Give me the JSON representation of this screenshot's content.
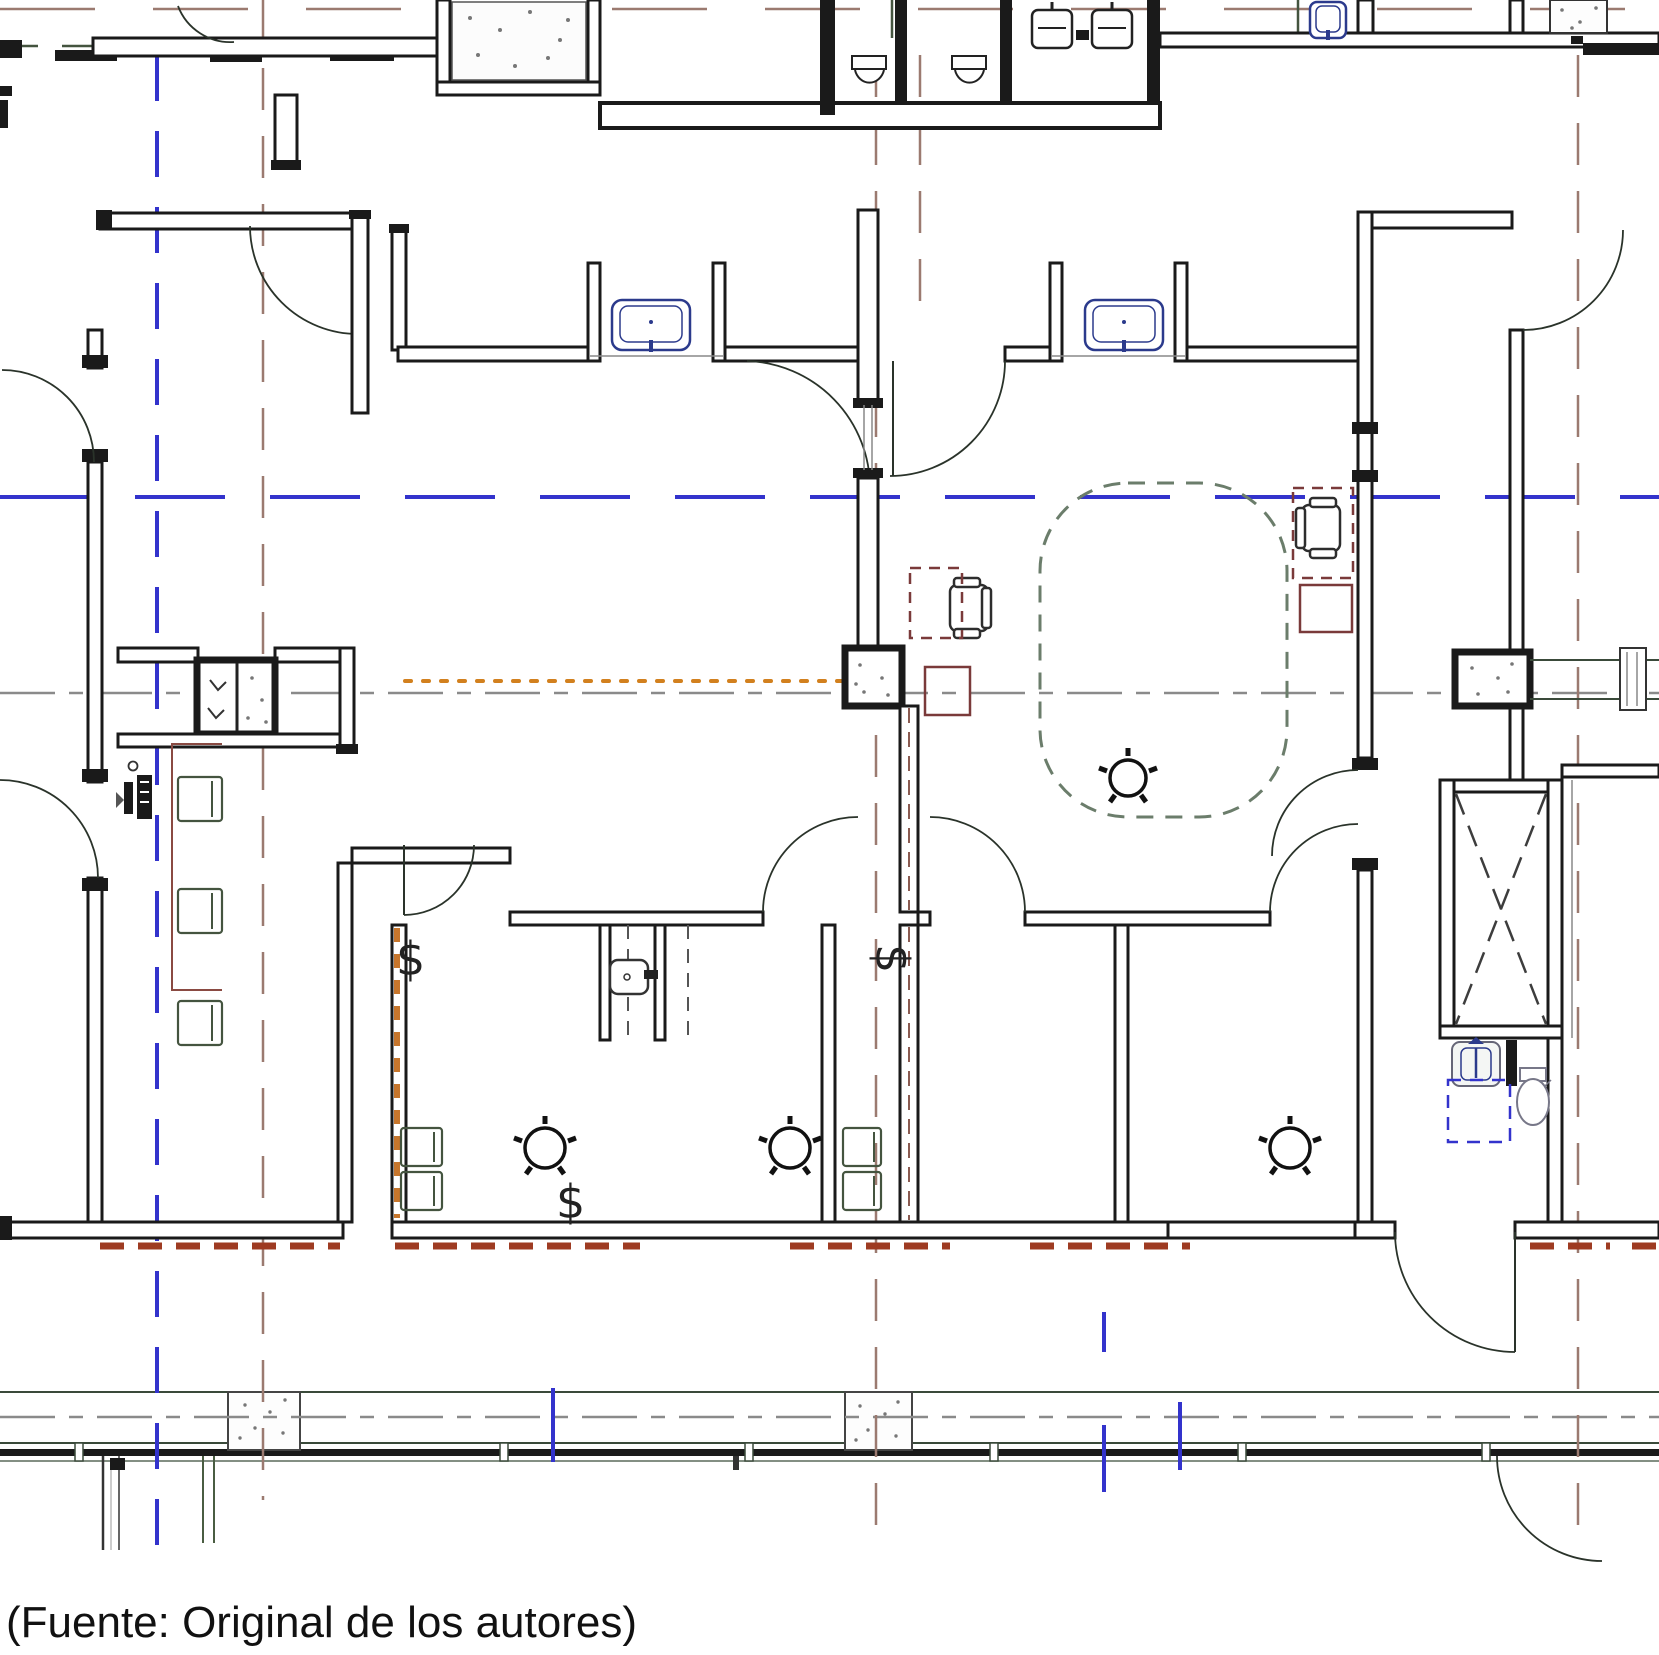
{
  "caption": {
    "text": "(Fuente: Original de los autores)"
  },
  "symbols": {
    "s1": "$",
    "s2": "$",
    "s3": "$"
  },
  "colors": {
    "wall": "#1a1a1a",
    "blue": "#3333cc",
    "brown": "#9b7a70",
    "orange": "#d2801e",
    "green": "#44543f",
    "maroon": "#7a3a3a",
    "redline": "#9e3b22",
    "fixblue": "#2b3a8c",
    "gray": "#8a8a8a",
    "ghost": "#6b7d6b",
    "dashmaroon": "#8a5a50"
  }
}
